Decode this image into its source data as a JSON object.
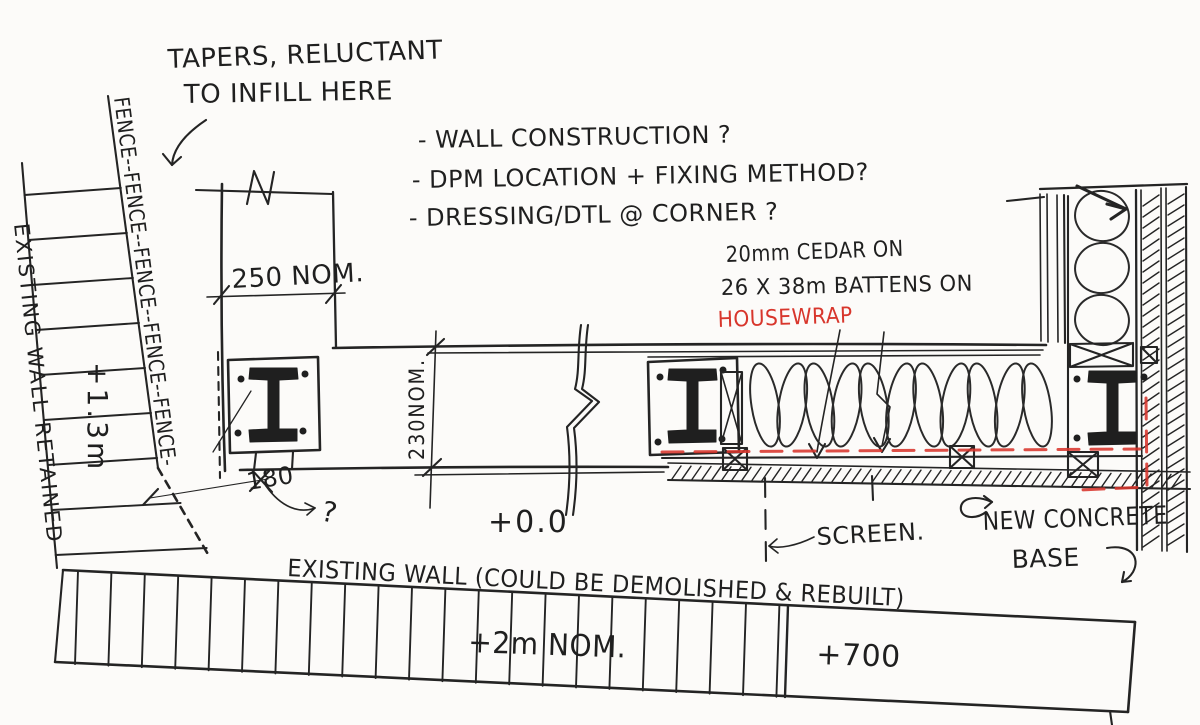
{
  "title": "Hand sketch - wall junction construction detail",
  "colors": {
    "ink": "#242424",
    "red": "#d8362c",
    "paper": "#fcfbf9"
  },
  "annotations": {
    "tapers_line1": "TAPERS, RELUCTANT",
    "tapers_line2": "TO INFILL HERE",
    "questions": [
      "- WALL CONSTRUCTION ?",
      "- DPM LOCATION + FIXING METHOD?",
      "- DRESSING/DTL @ CORNER ?"
    ],
    "cladding_line1": "20mm CEDAR ON",
    "cladding_line2": "26 X 38m BATTENS ON",
    "cladding_line3": "HOUSEWRAP",
    "screen": "SCREEN.",
    "new_concrete_line1": "NEW CONCRETE",
    "new_concrete_line2": "BASE",
    "question_mark": "?"
  },
  "dimensions": {
    "top_width": "250 NOM.",
    "wall_depth": "230NOM.",
    "fence_gap": "180",
    "level_zero": "+0.0",
    "fence_height": "+1.3m",
    "wall_length": "+2m NOM.",
    "level_700": "+700"
  },
  "labels": {
    "fence": "FENCE--FENCE--FENCE--FENCE--FENCE-",
    "existing_wall_left": "EXISTING WALL RETAINED",
    "existing_wall_bottom": "EXISTING WALL (COULD BE DEMOLISHED & REBUILT)"
  }
}
